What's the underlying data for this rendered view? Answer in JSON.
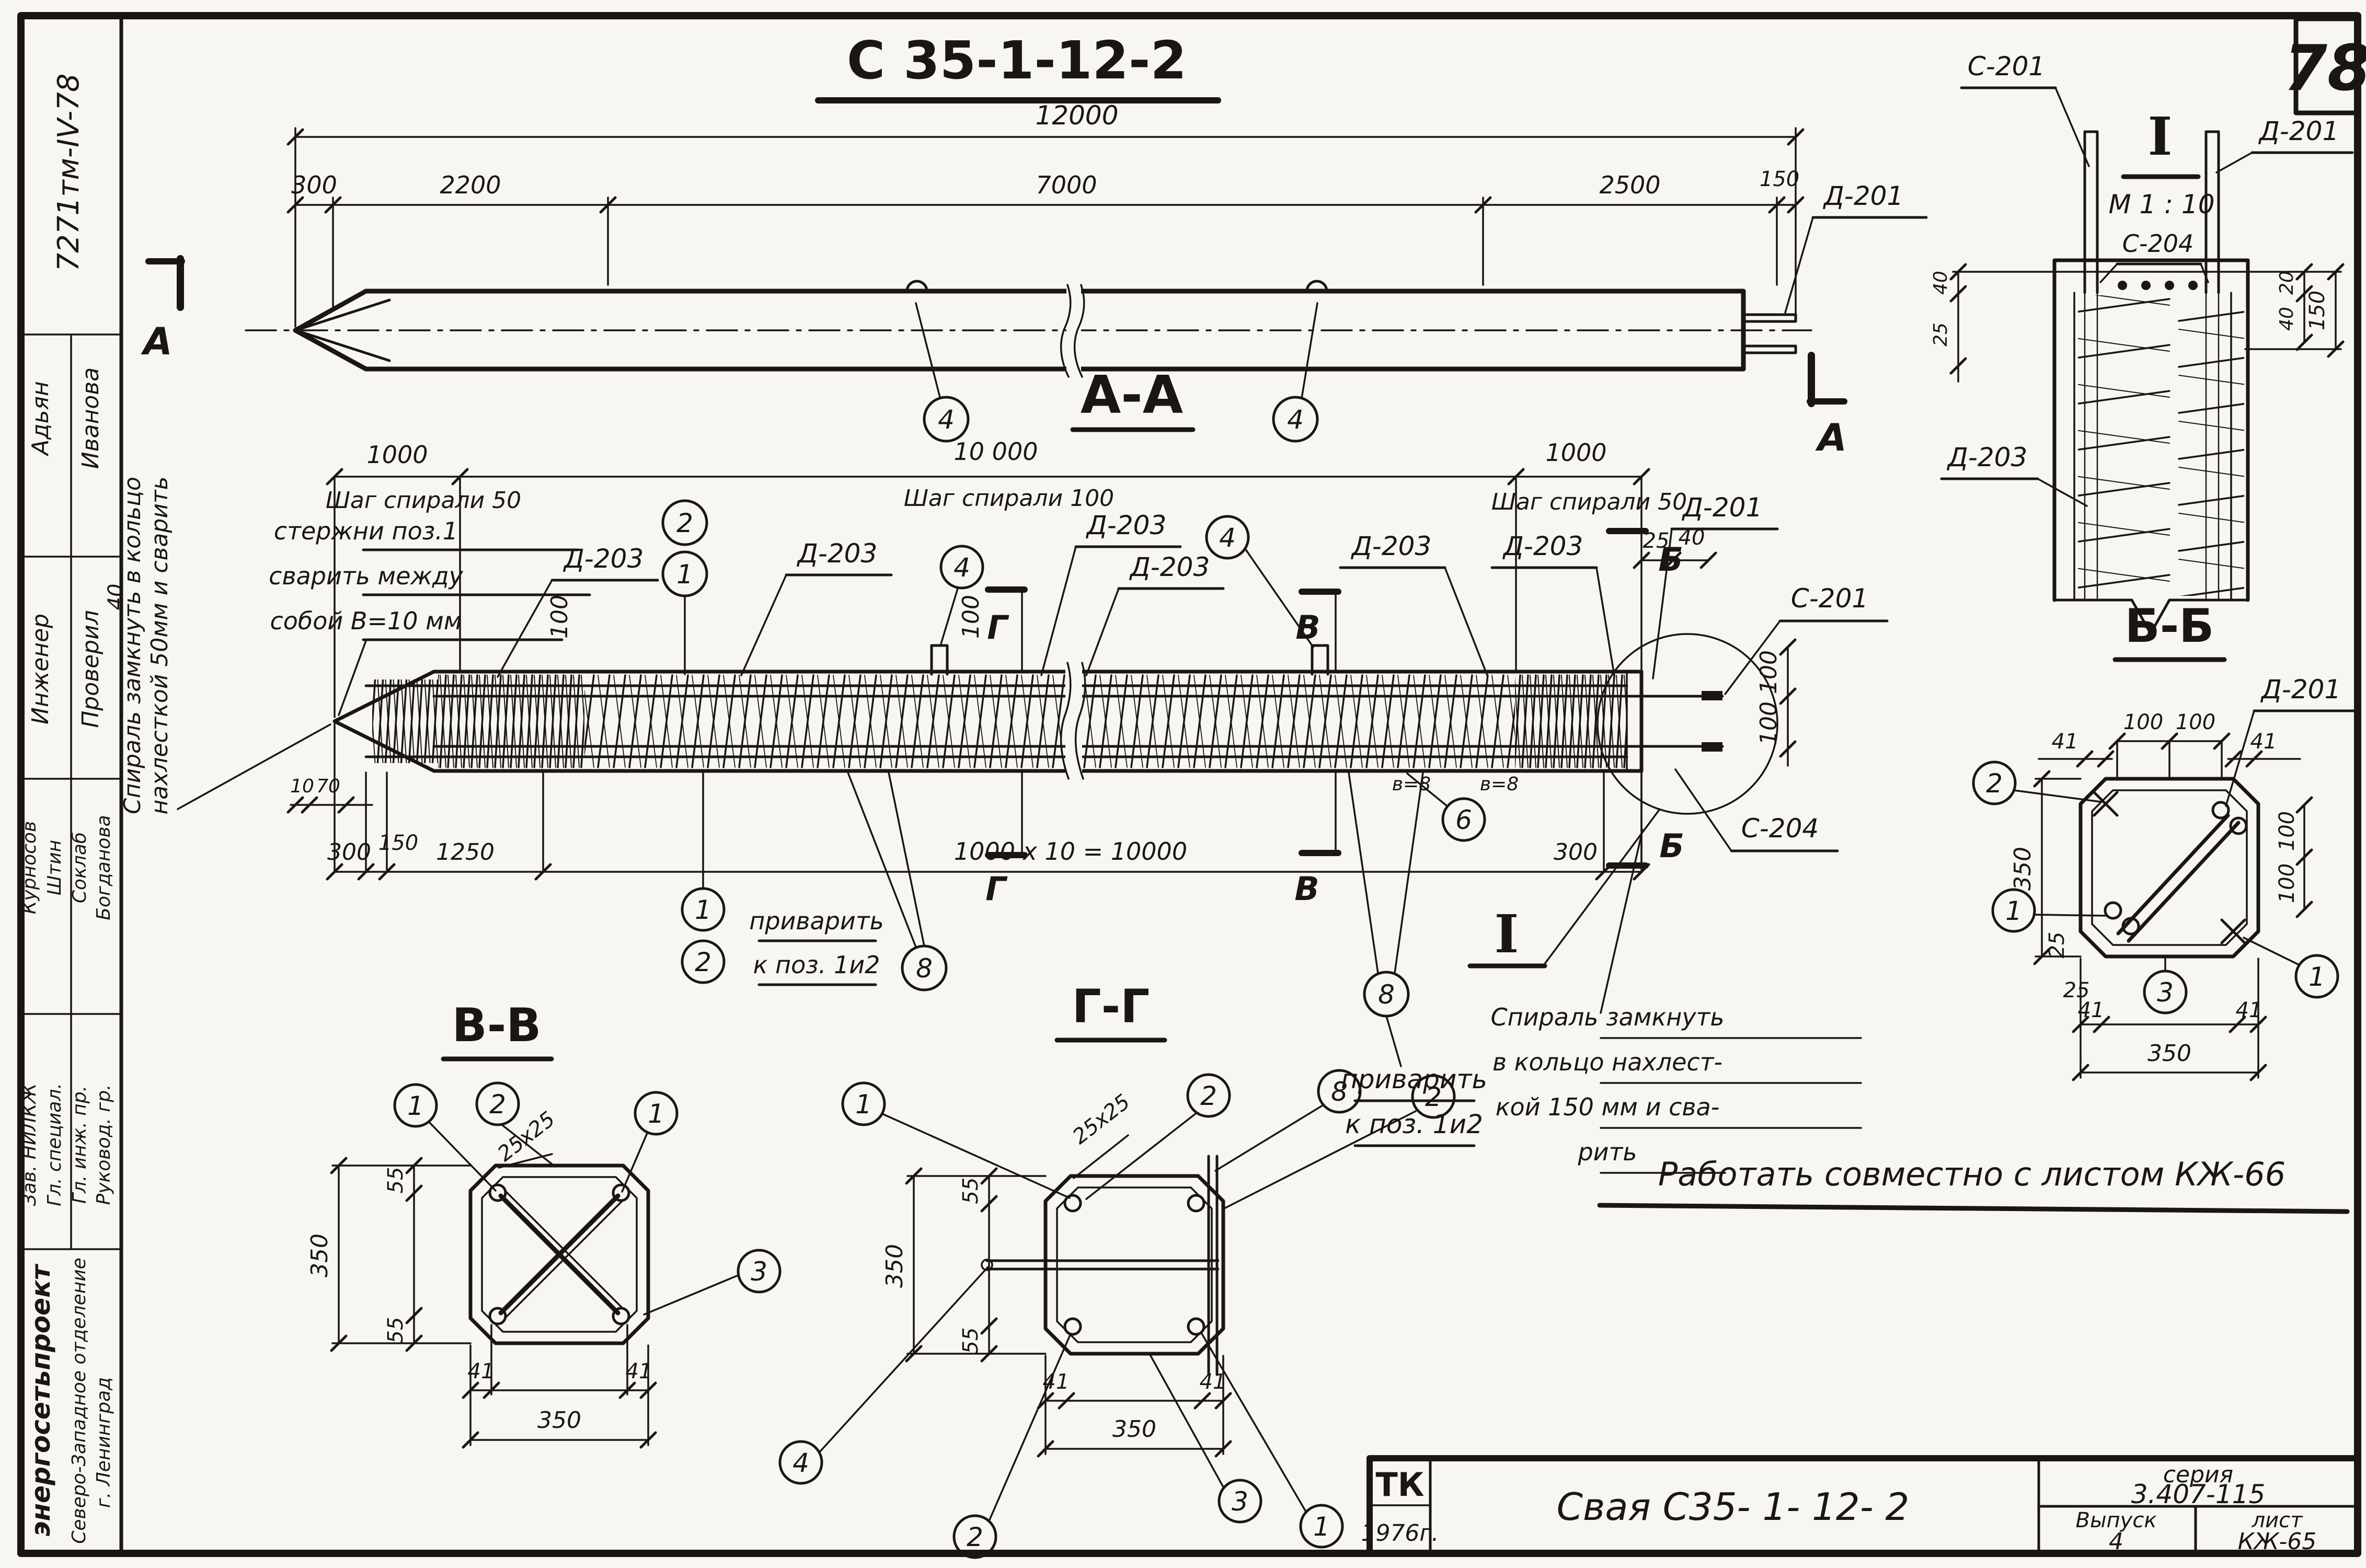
{
  "sheet": {
    "page_number": "78",
    "doc_code": "7271тм-IV-78",
    "main_title": "С 35-1-12-2",
    "work_note": "Работать  совместно  с  листом  КЖ-66"
  },
  "common": {
    "d203": "Д-203",
    "d201": "Д-201",
    "s201": "С-201",
    "s204": "С-204",
    "n1": "1",
    "n2": "2",
    "n3": "3",
    "n4": "4",
    "n6": "6",
    "n8": "8",
    "d41": "41",
    "d55": "55",
    "d100": "100",
    "d350": "350",
    "d25": "25",
    "d40": "40",
    "chamfer": "25х25",
    "len1000": "1000",
    "step50": "Шаг спирали 50",
    "letter_a": "А",
    "letter_b": "Б",
    "letter_v": "В",
    "letter_g": "Г"
  },
  "stamp": {
    "rows": [
      {
        "role": "Инженер",
        "name": "Адьян"
      },
      {
        "role": "Проверил",
        "name": "Иванова"
      },
      {
        "role": "Зав. НИЛКЖ",
        "name": "Курносов"
      },
      {
        "role": "Гл. специал.",
        "name": "Штин"
      },
      {
        "role": "Гл. инж. пр.",
        "name": "Соклаб"
      },
      {
        "role": "Руковод. гр.",
        "name": "Богданова"
      }
    ],
    "org": "энергосетьпроект",
    "branch": "Северо-Западное отделение",
    "city": "г. Ленинград"
  },
  "top_view": {
    "dim_total": "12000",
    "dims": [
      "300",
      "2200",
      "7000",
      "2500",
      "150"
    ]
  },
  "elevation": {
    "title": "А-А",
    "len10000": "10 000",
    "step100": "Шаг спирали 100",
    "note_left_1": "Спираль замкнуть в кольцо",
    "note_left_2": "нахлесткой 50мм и сварить",
    "note_box_1": "стержни поз.1",
    "note_box_2": "сварить между",
    "note_box_3": "собой  В=10 мм",
    "note_weld_1": "приварить",
    "note_weld_2": "к поз. 1и2",
    "note_spiral_1": "Спираль  замкнуть",
    "note_spiral_2": "в кольцо  нахлест-",
    "note_spiral_3": "кой   150 мм и сва-",
    "note_spiral_4": "рить",
    "weld_mark": "в=8",
    "detail_mark": "I",
    "d10": "10",
    "d70": "70",
    "d150": "150",
    "d1250": "1250",
    "d300": "300",
    "d10000": "1000 х 10 = 10000"
  },
  "section_vv": {
    "title": "В-В"
  },
  "section_gg": {
    "title": "Г-Г"
  },
  "section_bb": {
    "title": "Б-Б"
  },
  "detail_i": {
    "title": "I",
    "scale": "М 1 : 10",
    "d150": "150",
    "d20": "20"
  },
  "title_block": {
    "tk": "ТК",
    "year": "1976г.",
    "drawing_name": "Свая  С35- 1- 12- 2",
    "series_label": "серия",
    "series": "3.407-115",
    "issue_label": "Выпуск",
    "issue": "4",
    "sheet_label": "лист",
    "sheet": "КЖ-65"
  }
}
